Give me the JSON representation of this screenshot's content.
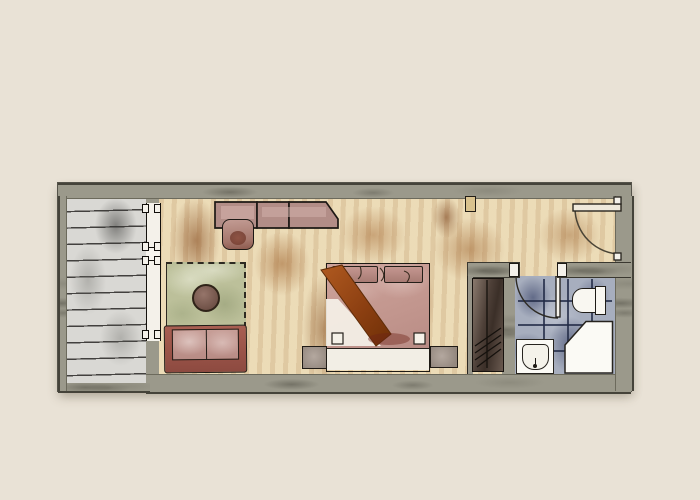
{
  "description": "Hand-drawn watercolor floor plan of a hotel guest room, no text labels",
  "rooms": {
    "balcony": {
      "label": "Balcony with wood-plank decking"
    },
    "bedroom": {
      "label": "Guest room with tan watercolor floor"
    },
    "entry": {
      "label": "Entry area with 90-degree swing door"
    },
    "bathroom": {
      "label": "Bathroom with blue tiled floor"
    }
  },
  "furniture": {
    "desk": {
      "label": "Console desk along top wall, three segments"
    },
    "desk_chair": {
      "label": "Desk chair"
    },
    "rug": {
      "label": "Green area rug with dashed edge"
    },
    "side_table": {
      "label": "Round side table"
    },
    "sofa": {
      "label": "Two-seat sofa facing the rug"
    },
    "bed": {
      "label": "Double bed with rust runner and two pillows"
    },
    "nightstand_left": {
      "label": "Nightstand left of bed"
    },
    "nightstand_right": {
      "label": "Nightstand right of bed"
    },
    "closet": {
      "label": "Closet / wardrobe in niche"
    }
  },
  "fixtures": {
    "entry_door": {
      "label": "Entry door with quarter-circle swing"
    },
    "bathroom_door": {
      "label": "Bathroom door with quarter-circle swing"
    },
    "window": {
      "label": "Glazed balcony door / window wall"
    },
    "toilet": {
      "label": "Toilet with tank against right wall"
    },
    "sink": {
      "label": "Washbasin on bottom wall"
    },
    "shower": {
      "label": "Shower / tub with angled corner"
    }
  },
  "palette": {
    "background": "#e9e2d6",
    "wall": "#9b998b",
    "floor_tan": "#ead9b4",
    "floor_stain": "#8a4a1a",
    "balcony_deck": "#d9d8d4",
    "rug_green": "#bcc09a",
    "upholstery_pink": "#c79e97",
    "sofa_frame": "#a95f52",
    "throw_rust": "#9a4a16",
    "closet_brown": "#4e4038",
    "bath_floor_blue": "#a7aebe",
    "fixture_white": "#f9f7f1",
    "ink": "#1e1a15"
  }
}
